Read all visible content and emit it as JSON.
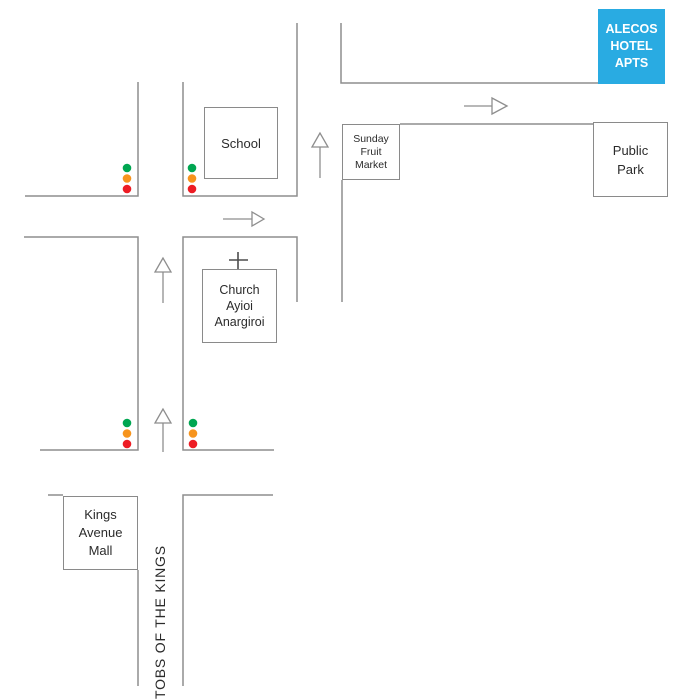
{
  "canvas": {
    "width": 692,
    "height": 700
  },
  "colors": {
    "road_line": "#8e8e8e",
    "box_border": "#8a8a8a",
    "text": "#2b2b2b",
    "hotel_bg": "#29abe2",
    "hotel_text": "#ffffff",
    "light_green": "#00a651",
    "light_orange": "#f7941d",
    "light_red": "#ed1c24"
  },
  "places": {
    "hotel": {
      "name": "Alecos Hotel Apts",
      "lines": [
        "ALECOS",
        "HOTEL",
        "APTS"
      ]
    },
    "school": {
      "label": "School"
    },
    "market": {
      "name": "Sunday Fruit Market",
      "lines": [
        "Sunday",
        "Fruit",
        "Market"
      ]
    },
    "park": {
      "name": "Public Park",
      "lines": [
        "Public",
        "Park"
      ]
    },
    "church": {
      "name": "Church Ayioi Anargiroi",
      "lines": [
        "Church",
        "Ayioi",
        "Anargiroi"
      ]
    },
    "mall": {
      "name": "Kings Avenue Mall",
      "lines": [
        "Kings",
        "Avenue",
        "Mall"
      ]
    }
  },
  "street": {
    "name": "TOBS OF THE KINGS"
  }
}
